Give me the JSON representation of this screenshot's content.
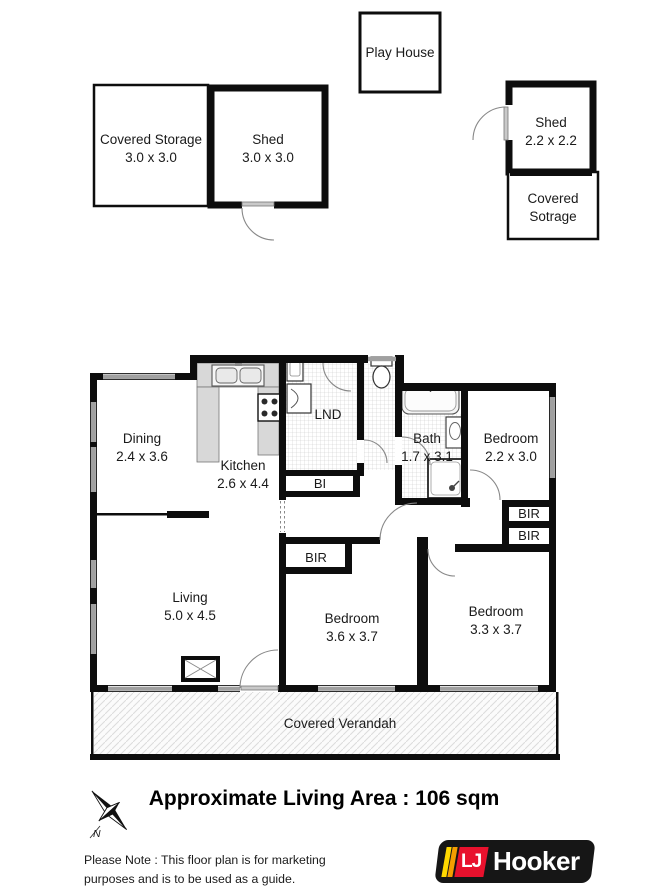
{
  "outbuildings": {
    "play_house": {
      "name": "Play House"
    },
    "covered_storage": {
      "name": "Covered Storage",
      "size": "3.0 x 3.0"
    },
    "shed_large": {
      "name": "Shed",
      "size": "3.0 x 3.0"
    },
    "shed_small": {
      "name": "Shed",
      "size": "2.2 x 2.2"
    },
    "covered_sotrage": {
      "name_line1": "Covered",
      "name_line2": "Sotrage"
    }
  },
  "rooms": {
    "dining": {
      "name": "Dining",
      "size": "2.4 x 3.6"
    },
    "kitchen": {
      "name": "Kitchen",
      "size": "2.6 x 4.4"
    },
    "laundry": {
      "name": "LND"
    },
    "bath": {
      "name": "Bath",
      "size": "1.7 x 3.1"
    },
    "bedroom_small": {
      "name": "Bedroom",
      "size": "2.2 x 3.0"
    },
    "living": {
      "name": "Living",
      "size": "5.0 x 4.5"
    },
    "bedroom_middle": {
      "name": "Bedroom",
      "size": "3.6 x 3.7"
    },
    "bedroom_right": {
      "name": "Bedroom",
      "size": "3.3 x 3.7"
    },
    "verandah": {
      "name": "Covered Verandah"
    }
  },
  "closets": {
    "built_in": "BI",
    "built_in_robe": "BIR"
  },
  "compass": {
    "north_label": "N"
  },
  "footer": {
    "area_text": "Approximate Living Area : 106 sqm",
    "note_line1": "Please Note : This floor plan is for marketing",
    "note_line2": "purposes and is to be used as a guide."
  },
  "logo": {
    "lj": "LJ",
    "brand": "Hooker",
    "colors": {
      "red": "#e8112d",
      "yellow": "#ffd800",
      "orange": "#f59e00",
      "black": "#161616"
    }
  },
  "colors": {
    "wall": "#0d0d0d",
    "window": "#a0a0a0",
    "counter": "#d8d8d8",
    "tile_line": "#cccccc",
    "hatch_line": "#dcdcdc"
  }
}
